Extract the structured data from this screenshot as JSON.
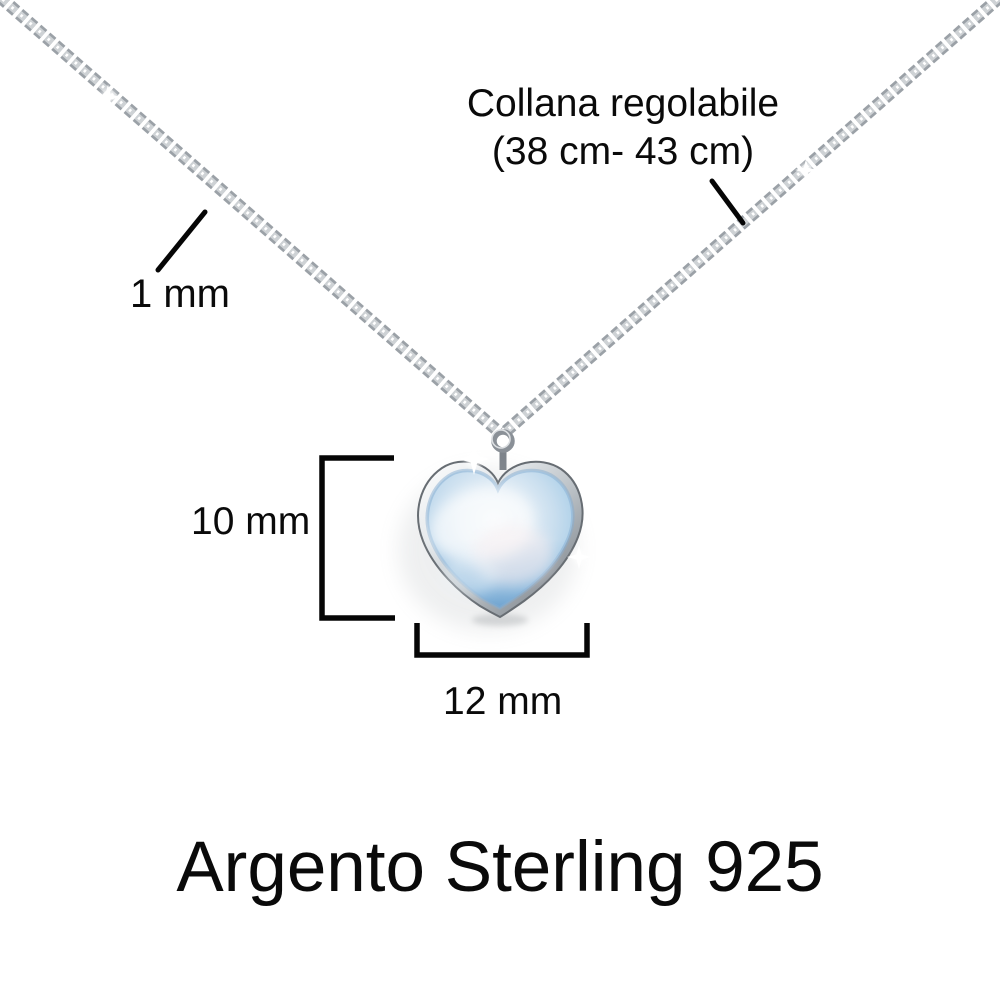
{
  "image": {
    "type": "product-dimension-photo",
    "background_color": "#ffffff",
    "caption": "Argento Sterling 925",
    "annotations": {
      "chain_adjustable_line1": "Collana regolabile",
      "chain_adjustable_line2": "(38 cm- 43 cm)",
      "chain_thickness": "1 mm",
      "pendant_height": "10 mm",
      "pendant_width": "12 mm"
    },
    "colors": {
      "annotation_text": "#0a0a0a",
      "dimension_lines": "#060606",
      "chain_silver_base": "#9ba1a7",
      "chain_silver_light": "#ced2d5",
      "frame_silver_light": "#f7f8f9",
      "frame_silver_dark": "#6b7178",
      "stone_blue_light": "#e4eef6",
      "stone_blue": "#a9cde7",
      "stone_blue_deep": "#7fb0d8",
      "highlight_white": "#ffffff"
    }
  }
}
